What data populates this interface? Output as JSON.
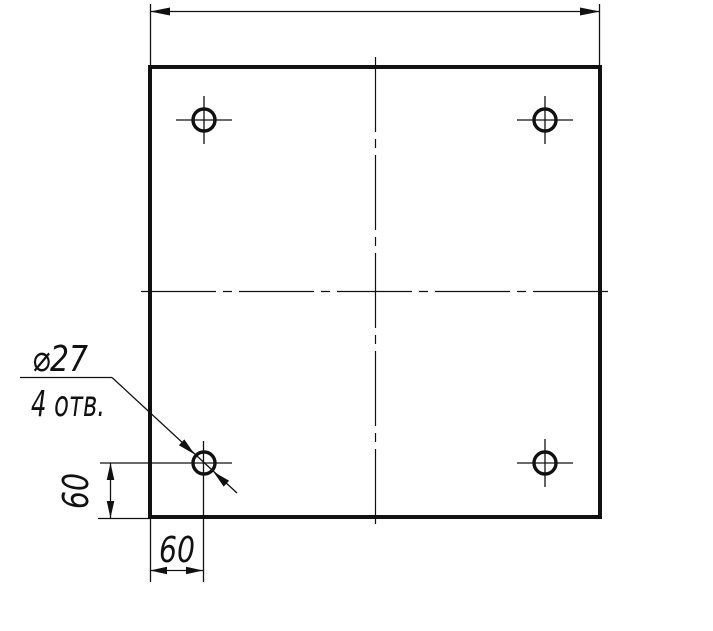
{
  "canvas": {
    "width": 713,
    "height": 631,
    "background": "#ffffff",
    "line_color": "#111111"
  },
  "drawing": {
    "callout": {
      "diameter": "⌀27",
      "count": "4 отв."
    },
    "dims": {
      "offset_x": "60",
      "offset_y": "60"
    },
    "annotations": {
      "hole_count": 4,
      "hole_diameter": 27,
      "hole_offset_from_left": 60,
      "hole_offset_from_bottom": 60,
      "overall_width_dimension_label": ""
    }
  }
}
